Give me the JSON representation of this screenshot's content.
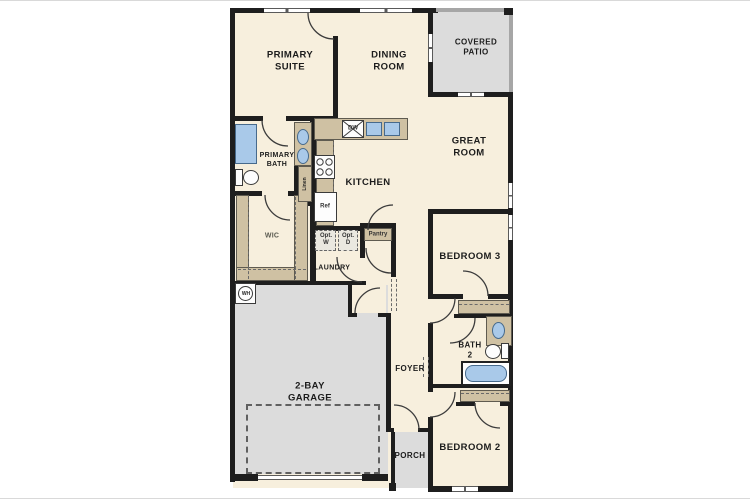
{
  "title": "Single-story floor plan",
  "colors": {
    "wall": "#1e1e1e",
    "floor_cream": "#f7efdd",
    "concrete_gray": "#dcdcdc",
    "casework_tan": "#cfc1a3",
    "fixture_blue": "#a9c9e9"
  },
  "rooms": {
    "primary_suite": {
      "label": "PRIMARY\nSUITE"
    },
    "dining_room": {
      "label": "DINING\nROOM"
    },
    "covered_patio": {
      "label": "COVERED\nPATIO"
    },
    "great_room": {
      "label": "GREAT\nROOM"
    },
    "primary_bath": {
      "label": "PRIMARY\nBATH"
    },
    "kitchen": {
      "label": "KITCHEN"
    },
    "wic": {
      "label": "WIC"
    },
    "laundry": {
      "label": "LAUNDRY"
    },
    "garage": {
      "label": "2-BAY\nGARAGE"
    },
    "foyer": {
      "label": "FOYER"
    },
    "porch": {
      "label": "PORCH"
    },
    "bedroom3": {
      "label": "BEDROOM 3"
    },
    "bath2": {
      "label": "BATH\n2"
    },
    "bedroom2": {
      "label": "BEDROOM 2"
    }
  },
  "fixtures": {
    "dishwasher": "DW",
    "refrigerator": "Ref",
    "opt_washer": "Opt.\nW",
    "opt_dryer": "Opt.\nD",
    "pantry": "Pantry",
    "linen": "Linen",
    "water_heater": "WH"
  }
}
